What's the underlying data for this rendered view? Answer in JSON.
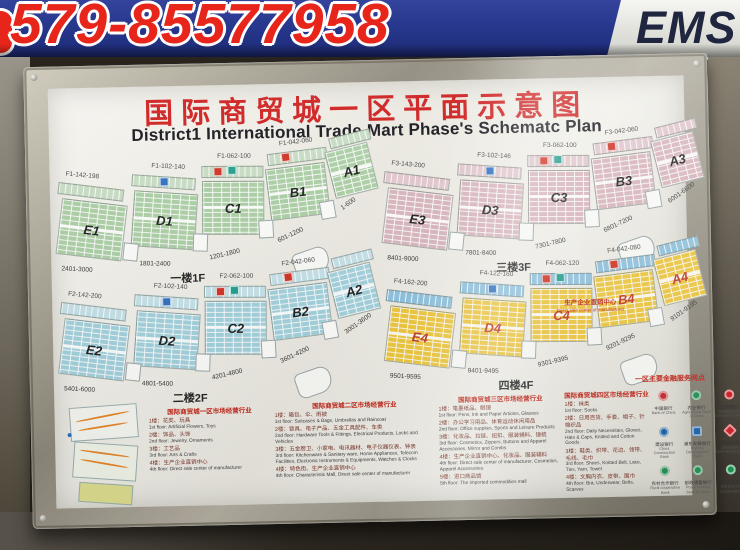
{
  "banner": {
    "phone": "579-85577958",
    "ems": "EMS"
  },
  "header": {
    "title_cn": "国际商贸城一区平面示意图",
    "title_en": "District1 International Trade Mart Phase's Schematc Plan"
  },
  "floors": [
    {
      "id": "1F",
      "title_cn": "一楼",
      "title_suffix": "1F",
      "sections": [
        "E1",
        "D1",
        "C1",
        "B1",
        "A1"
      ],
      "strip_labels": [
        "F1-142-198",
        "F1-102-140",
        "F1-062-100",
        "F1-042-060"
      ],
      "ranges": [
        "2401-3000",
        "1801-2400",
        "1201-1800",
        "601-1200",
        "1-600"
      ],
      "color": "#abcfa4",
      "strip_color": "#c8ddc4",
      "letter_color": "#1d1d1d"
    },
    {
      "id": "2F",
      "title_cn": "二楼",
      "title_suffix": "2F",
      "sections": [
        "E2",
        "D2",
        "C2",
        "B2",
        "A2"
      ],
      "strip_labels": [
        "F2-142-200",
        "F2-102-140",
        "F2-062-100",
        "F2-042-060"
      ],
      "ranges": [
        "5401-6000",
        "4801-5400",
        "4201-4800",
        "3601-4200",
        "3001-3600"
      ],
      "color": "#a2d2de",
      "strip_color": "#c6e2ea",
      "letter_color": "#1d1d1d"
    },
    {
      "id": "3F",
      "title_cn": "三楼",
      "title_suffix": "3F",
      "sections": [
        "E3",
        "D3",
        "C3",
        "B3",
        "A3"
      ],
      "strip_labels": [
        "F3-143-200",
        "F3-102-146",
        "F3-062-100",
        "F3-042-060"
      ],
      "ranges": [
        "8401-9000",
        "7801-8400",
        "7301-7800",
        "6801-7200",
        "6001-6600"
      ],
      "color": "#d9b6bd",
      "strip_color": "#e2c8ce",
      "letter_color": "#1d1d1d"
    },
    {
      "id": "4F",
      "title_cn": "四楼",
      "title_suffix": "4F",
      "sections": [
        "E4",
        "D4",
        "C4",
        "B4",
        "A4"
      ],
      "strip_labels": [
        "F4-162-200",
        "F4-122-160",
        "F4-062-120",
        "F4-042-080"
      ],
      "ranges": [
        "9501-9595",
        "9401-9495",
        "9301-9395",
        "9201-9295",
        "9101-9195"
      ],
      "color": "#f0c83a",
      "strip_color": "#8fc3e0",
      "letter_color": "#c03428",
      "annotation_cn": "生产企业直销中心",
      "annotation_en": "Direct sale center of manufacturer"
    }
  ],
  "legends": [
    {
      "title": "国际商贸城一区市场经营行业",
      "rows": [
        {
          "cn": "1楼：花类、玩具",
          "en": "1st floor: Artificial Flowers, Toys"
        },
        {
          "cn": "2楼：饰品、头饰",
          "en": "2nd floor: Jewelry, Ornaments"
        },
        {
          "cn": "3楼：工艺品",
          "en": "3rd floor: Arts & Crafts"
        },
        {
          "cn": "4楼：生产企业直销中心",
          "en": "4th floor: Direct sale center of manufacturer"
        }
      ]
    },
    {
      "title": "国际商贸城二区市场经营行业",
      "rows": [
        {
          "cn": "1楼：箱包、伞、雨披",
          "en": "1st floor: Suitcases & Bags, Umbrellas and Raincoat"
        },
        {
          "cn": "2楼：锁具、电子产品、五金工具配件、车类",
          "en": "2nd floor: Hardware Tools & Fittings, Electrical Products, Locks and Vehicles"
        },
        {
          "cn": "3楼：五金厨卫、小家电、电讯器材、电子仪器仪表、钟表",
          "en": "3rd floor: Kitchenware & Sanitary ware, Home Appliances, Telecom Facilities, Electronic Instruments & Equipments, Watches & Clocks"
        },
        {
          "cn": "4楼：特色街、生产企业直销中心",
          "en": "4th floor: Characteristic Mall, Direct sale center of manufacturer"
        }
      ]
    },
    {
      "title": "国际商贸城三区市场经营行业",
      "rows": [
        {
          "cn": "1楼：笔墨纸品、眼镜",
          "en": "1st floor: Pens, Ink and Paper Articles, Glasses"
        },
        {
          "cn": "2楼：办公学习用品、体育运动休闲用品",
          "en": "2nd floor: Office supplies, Sports and Leisure Products"
        },
        {
          "cn": "3楼：化妆品、拉链、纽扣、服装辅料、镜梳",
          "en": "3rd floor: Cosmetics, Zippers, Buttons and Apparel Accessories, Mirror and Combs"
        },
        {
          "cn": "4楼：生产企业直销中心、化妆品、服装辅料",
          "en": "4th floor: Direct sale center of manufacturer, Cosmetics, Apparel Accessories"
        },
        {
          "cn": "5楼：进口商品馆",
          "en": "5th floor: The imported commodities mall"
        }
      ]
    },
    {
      "title": "国际商贸城四区市场经营行业",
      "rows": [
        {
          "cn": "1楼：袜类",
          "en": "1st floor: Socks"
        },
        {
          "cn": "2楼：日用百货、手套、帽子、针棉织品",
          "en": "2nd floor: Daily Necessities, Gloves, Hats & Caps, Knitted and Cotton Goods"
        },
        {
          "cn": "3楼：鞋类、织带、花边、领带、毛线、毛巾",
          "en": "3rd floor: Shoes, Knitted Belt, Lace, Ties, Yarn, Towel"
        },
        {
          "cn": "4楼：文胸内衣、皮带、围巾",
          "en": "4th floor: Bra, Underwear, Belts, Scarves"
        }
      ]
    }
  ],
  "banks": {
    "title": "一区主要金融服务网点",
    "items": [
      {
        "cn": "中国银行",
        "en": "Bank of China",
        "color": "#c9252b",
        "shape": "circle"
      },
      {
        "cn": "农业银行",
        "en": "Agricultural Bank of China",
        "color": "#1e8f4e",
        "shape": "circle"
      },
      {
        "cn": "工商银行",
        "en": "Industrial and Commercial Bank",
        "color": "#c9252b",
        "shape": "circle"
      },
      {
        "cn": "建设银行",
        "en": "China Construction Bank",
        "color": "#1560a8",
        "shape": "circle"
      },
      {
        "cn": "浦东发展银行",
        "en": "Pudong Development Bank",
        "color": "#1560a8",
        "shape": "square"
      },
      {
        "cn": "稠州商业银行",
        "en": "Chouzhou Commercial Bank",
        "color": "#c9252b",
        "shape": "diamond"
      },
      {
        "cn": "农村合作银行",
        "en": "Rural cooperative Bank",
        "color": "#1e8f4e",
        "shape": "circle"
      },
      {
        "cn": "邮政储蓄银行",
        "en": "Postal savings bank of China",
        "color": "#1e8f4e",
        "shape": "circle"
      },
      {
        "cn": "中国信合",
        "en": "China Credit Cooperatives",
        "color": "#1e8f4e",
        "shape": "circle"
      }
    ]
  },
  "colors": {
    "banner_blue": "#26368c",
    "phone_red": "#e8251a",
    "title_red": "#cf1d1d",
    "ems_navy": "#20263f",
    "chip_red": "#d03020",
    "chip_blue": "#2d6fc2",
    "chip_teal": "#1f9e8e"
  }
}
